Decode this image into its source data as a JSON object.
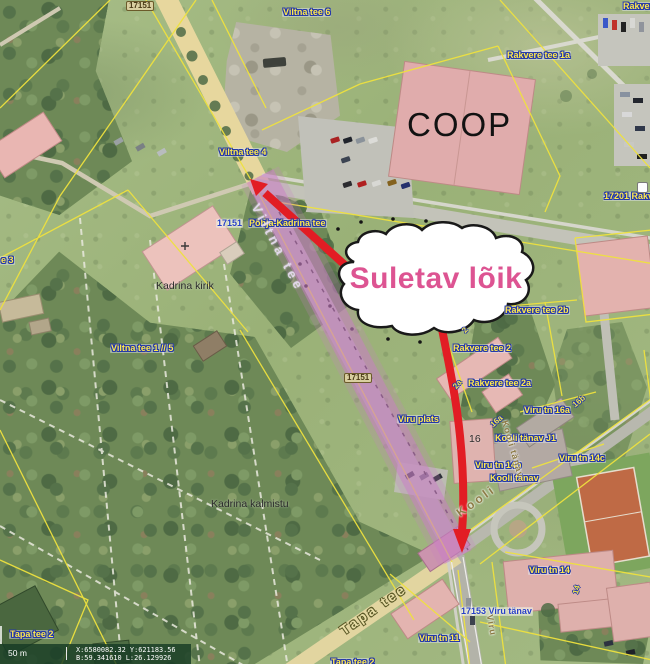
{
  "map": {
    "callout": {
      "text": "Suletav lõik"
    },
    "statusbar": {
      "scale_label": "50 m",
      "coords_line1": "X:6580082.32 Y:621183.56",
      "coords_line2": "B:59.341610 L:26.129926"
    },
    "colors": {
      "closure_overlay": "#c97ec6",
      "arrow_red": "#e21d24",
      "callout_text": "#dd5492",
      "cadastral_yellow": "#efe23e",
      "label_yellow": "#ffe94d",
      "label_blue": "#2840c8"
    },
    "labels": [
      {
        "id": "badge-17151-top",
        "text": "17151",
        "x": 126,
        "y": 1,
        "cls": "badge"
      },
      {
        "id": "label-viltna-tee-6",
        "text": "Viltna tee 6",
        "x": 282,
        "y": 8,
        "cls": "addr"
      },
      {
        "id": "label-rakvere-cut",
        "text": "Rakvere",
        "x": 622,
        "y": 2,
        "cls": "addr"
      },
      {
        "id": "label-rakvere-tee-1a",
        "text": "Rakvere tee 1a",
        "x": 506,
        "y": 51,
        "cls": "addr"
      },
      {
        "id": "label-coop",
        "text": "COOP",
        "x": 407,
        "y": 108,
        "cls": "coop"
      },
      {
        "id": "label-viltna-tee-4",
        "text": "Viltna tee 4",
        "x": 218,
        "y": 148,
        "cls": "addr"
      },
      {
        "id": "label-17201-rakvere",
        "text": "17201 Rakv",
        "x": 603,
        "y": 192,
        "cls": "addr"
      },
      {
        "id": "label-roadnum-17151",
        "text": "17151",
        "x": 216,
        "y": 219,
        "cls": "roadnum"
      },
      {
        "id": "label-pohja-kadrina-tee",
        "text": "Põhja-Kadrina tee",
        "x": 248,
        "y": 219,
        "cls": "addr"
      },
      {
        "id": "label-kadrina-kirik",
        "text": "Kadrina kirik",
        "x": 156,
        "y": 281,
        "cls": "plain"
      },
      {
        "id": "label-fragment-e3",
        "text": "e 3",
        "x": 0,
        "y": 256,
        "cls": "addr"
      },
      {
        "id": "label-rakvere-tee-2b",
        "text": "Rakvere tee 2b",
        "x": 504,
        "y": 306,
        "cls": "addr"
      },
      {
        "id": "label-rakvere-tee-2",
        "text": "Rakvere tee 2",
        "x": 452,
        "y": 344,
        "cls": "addr"
      },
      {
        "id": "label-rakvere-tee-2a",
        "text": "Rakvere tee 2a",
        "x": 467,
        "y": 379,
        "cls": "addr"
      },
      {
        "id": "label-viltna-tee-1-5",
        "text": "Viltna tee 1 // 5",
        "x": 110,
        "y": 344,
        "cls": "addr"
      },
      {
        "id": "badge-17151-mid",
        "text": "17151",
        "x": 344,
        "y": 373,
        "cls": "badge-sm"
      },
      {
        "id": "label-viru-tn-16a",
        "text": "Viru tn 16a",
        "x": 523,
        "y": 406,
        "cls": "addr"
      },
      {
        "id": "label-viru-plats",
        "text": "Viru plats",
        "x": 397,
        "y": 415,
        "cls": "addr"
      },
      {
        "id": "label-16",
        "text": "16",
        "x": 469,
        "y": 434,
        "cls": "plain"
      },
      {
        "id": "label-kooli-tanav-j1",
        "text": "Kooli tänav J1",
        "x": 494,
        "y": 434,
        "cls": "addr"
      },
      {
        "id": "label-viru-tn-14c",
        "text": "Viru tn 14c",
        "x": 558,
        "y": 454,
        "cls": "addr"
      },
      {
        "id": "label-viru-tn-14b",
        "text": "Viru tn 14b",
        "x": 474,
        "y": 461,
        "cls": "addr"
      },
      {
        "id": "label-kooli-tanav",
        "text": "Kooli tänav",
        "x": 489,
        "y": 474,
        "cls": "addr"
      },
      {
        "id": "label-kadrina-kalmistu",
        "text": "Kadrina kalmistu",
        "x": 211,
        "y": 499,
        "cls": "plain"
      },
      {
        "id": "label-viru-tn-14",
        "text": "Viru tn 14",
        "x": 528,
        "y": 566,
        "cls": "addr"
      },
      {
        "id": "label-17153-viru-tanav",
        "text": "17153 Viru tänav",
        "x": 460,
        "y": 607,
        "cls": "roadnum"
      },
      {
        "id": "label-viru-tn-11",
        "text": "Viru tn 11",
        "x": 418,
        "y": 634,
        "cls": "addr"
      },
      {
        "id": "label-tapa-tee-2",
        "text": "Tapa tee 2",
        "x": 9,
        "y": 630,
        "cls": "addr"
      },
      {
        "id": "label-tapa-tee-2-cut",
        "text": "Tapa tee 2",
        "x": 330,
        "y": 658,
        "cls": "addr"
      },
      {
        "id": "roadname-viltna-tee",
        "text": "Viltna tee",
        "x": 255,
        "y": 198,
        "cls": "roadname-light",
        "rot": 62
      },
      {
        "id": "roadname-tapa-tee",
        "text": "Tapa tee",
        "x": 342,
        "y": 625,
        "cls": "roadname-tan",
        "rot": -35
      },
      {
        "id": "roadname-kooli-tanav-vertical",
        "text": "Kooli tänav",
        "x": 504,
        "y": 416,
        "cls": "roadname",
        "rot": 74
      },
      {
        "id": "roadname-kooli",
        "text": "Kooli",
        "x": 458,
        "y": 508,
        "cls": "roadname-lg",
        "rot": -36
      },
      {
        "id": "roadname-viru",
        "text": "Viru",
        "x": 489,
        "y": 610,
        "cls": "roadname",
        "rot": 80
      },
      {
        "id": "parcel-2",
        "text": "2",
        "x": 464,
        "y": 328,
        "cls": "parcel",
        "rot": -50
      },
      {
        "id": "parcel-2a",
        "text": "2a",
        "x": 455,
        "y": 384,
        "cls": "parcel",
        "rot": -50
      },
      {
        "id": "parcel-16a",
        "text": "16a",
        "x": 492,
        "y": 422,
        "cls": "parcel",
        "rot": -42
      },
      {
        "id": "parcel-16b",
        "text": "16b",
        "x": 574,
        "y": 402,
        "cls": "parcel",
        "rot": -40
      },
      {
        "id": "parcel-14",
        "text": "14",
        "x": 576,
        "y": 590,
        "cls": "parcel",
        "rot": -75
      }
    ]
  }
}
